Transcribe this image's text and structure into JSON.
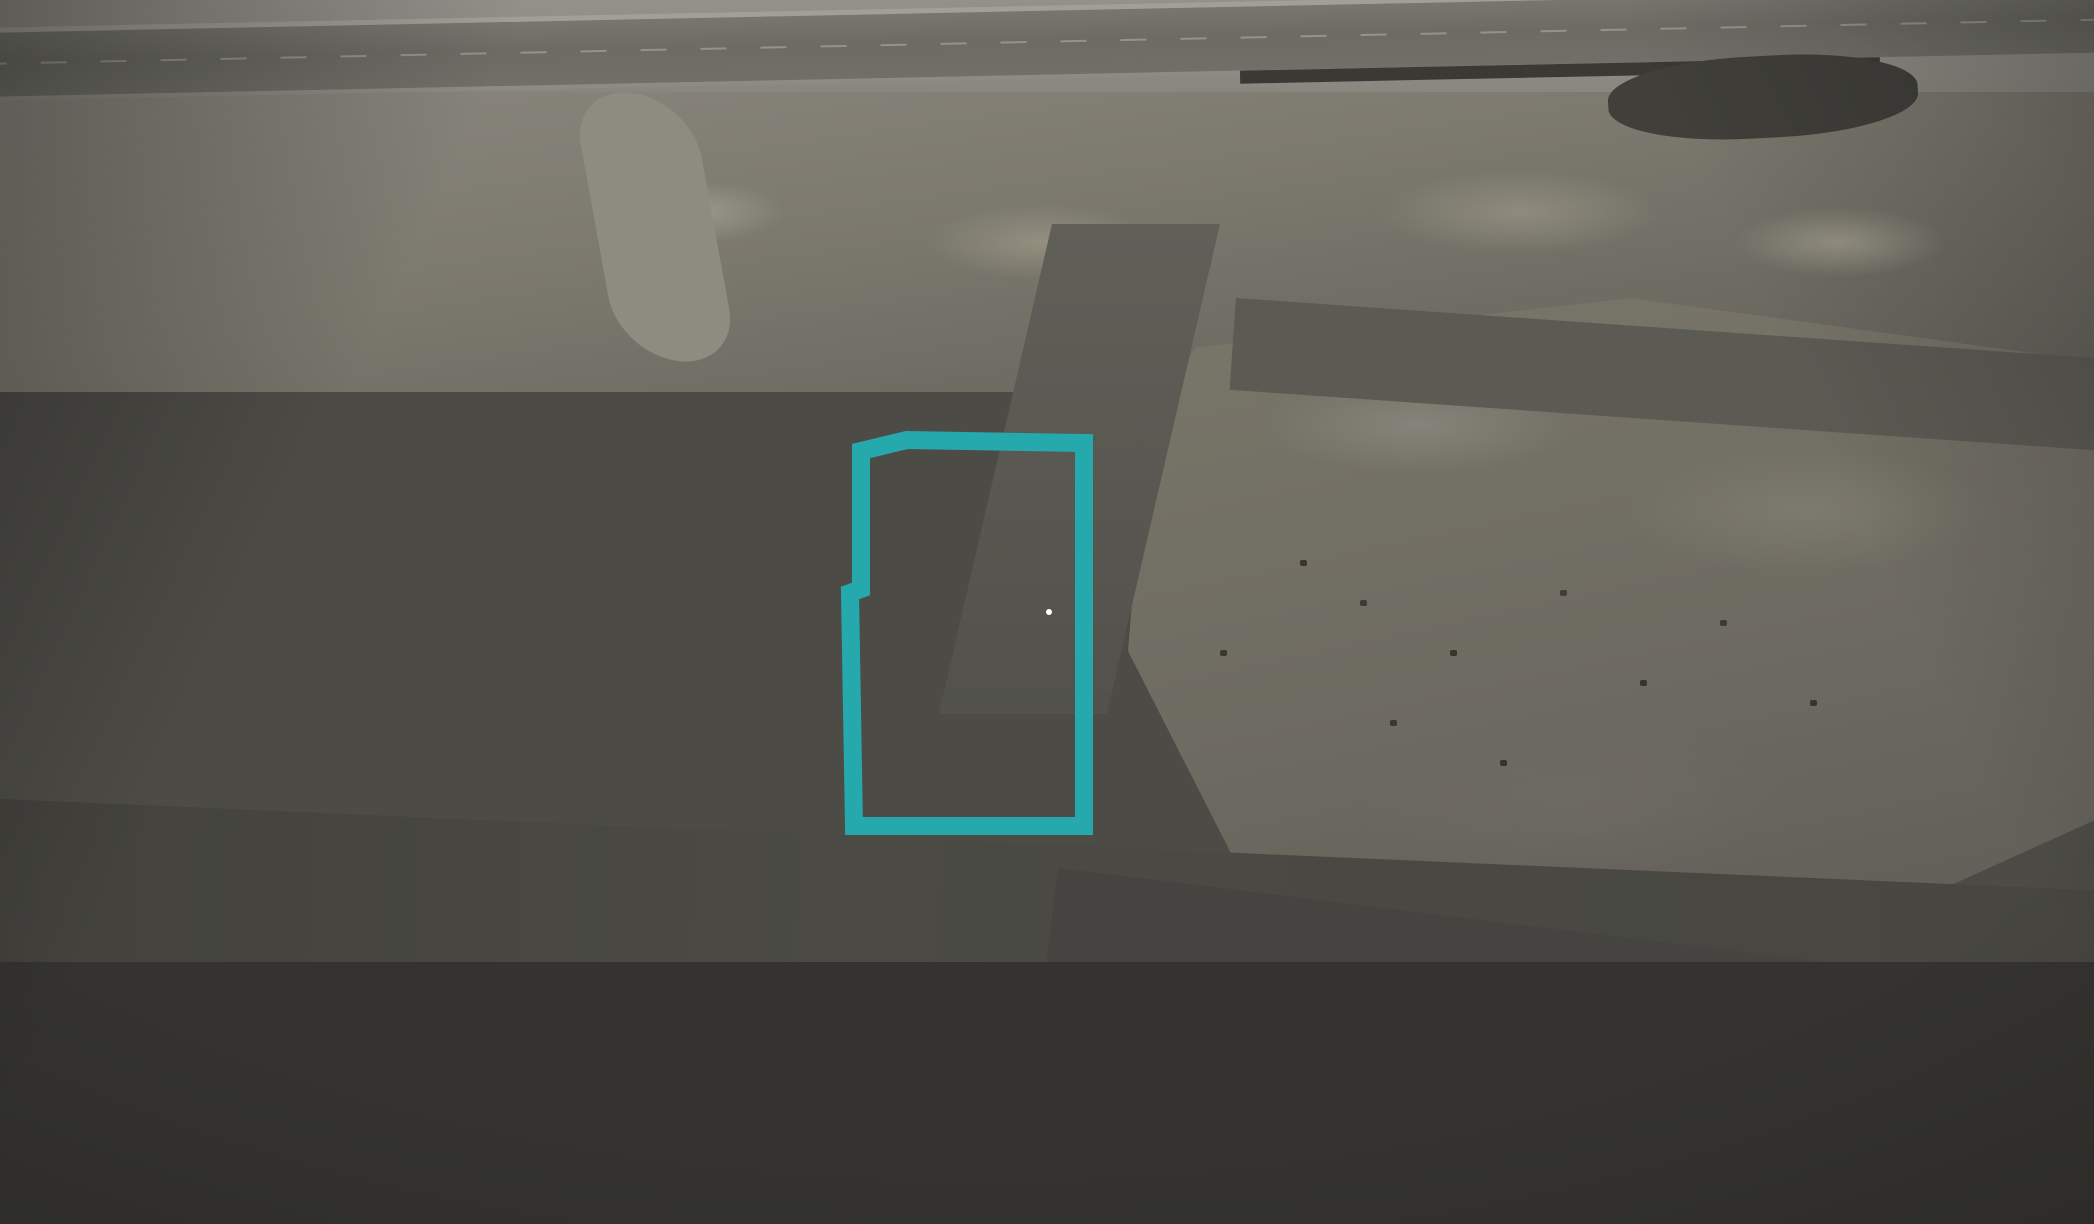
{
  "scene": {
    "description": "Aerial drone photo of a desert villa neighborhood, fully desaturated gray except one villa shown in color and framed by a teal outline",
    "highlighted_property": "two-storey cream villa with garage"
  },
  "watermark": {
    "text": "wasalt.com",
    "pin_icon": "map-pin"
  },
  "colors": {
    "outline_teal": "#25a9ac",
    "pin_purple": "#6c4da1",
    "watermark_text": "#4f4f58",
    "watermark_pill": "rgba(255,255,255,0.82)"
  }
}
